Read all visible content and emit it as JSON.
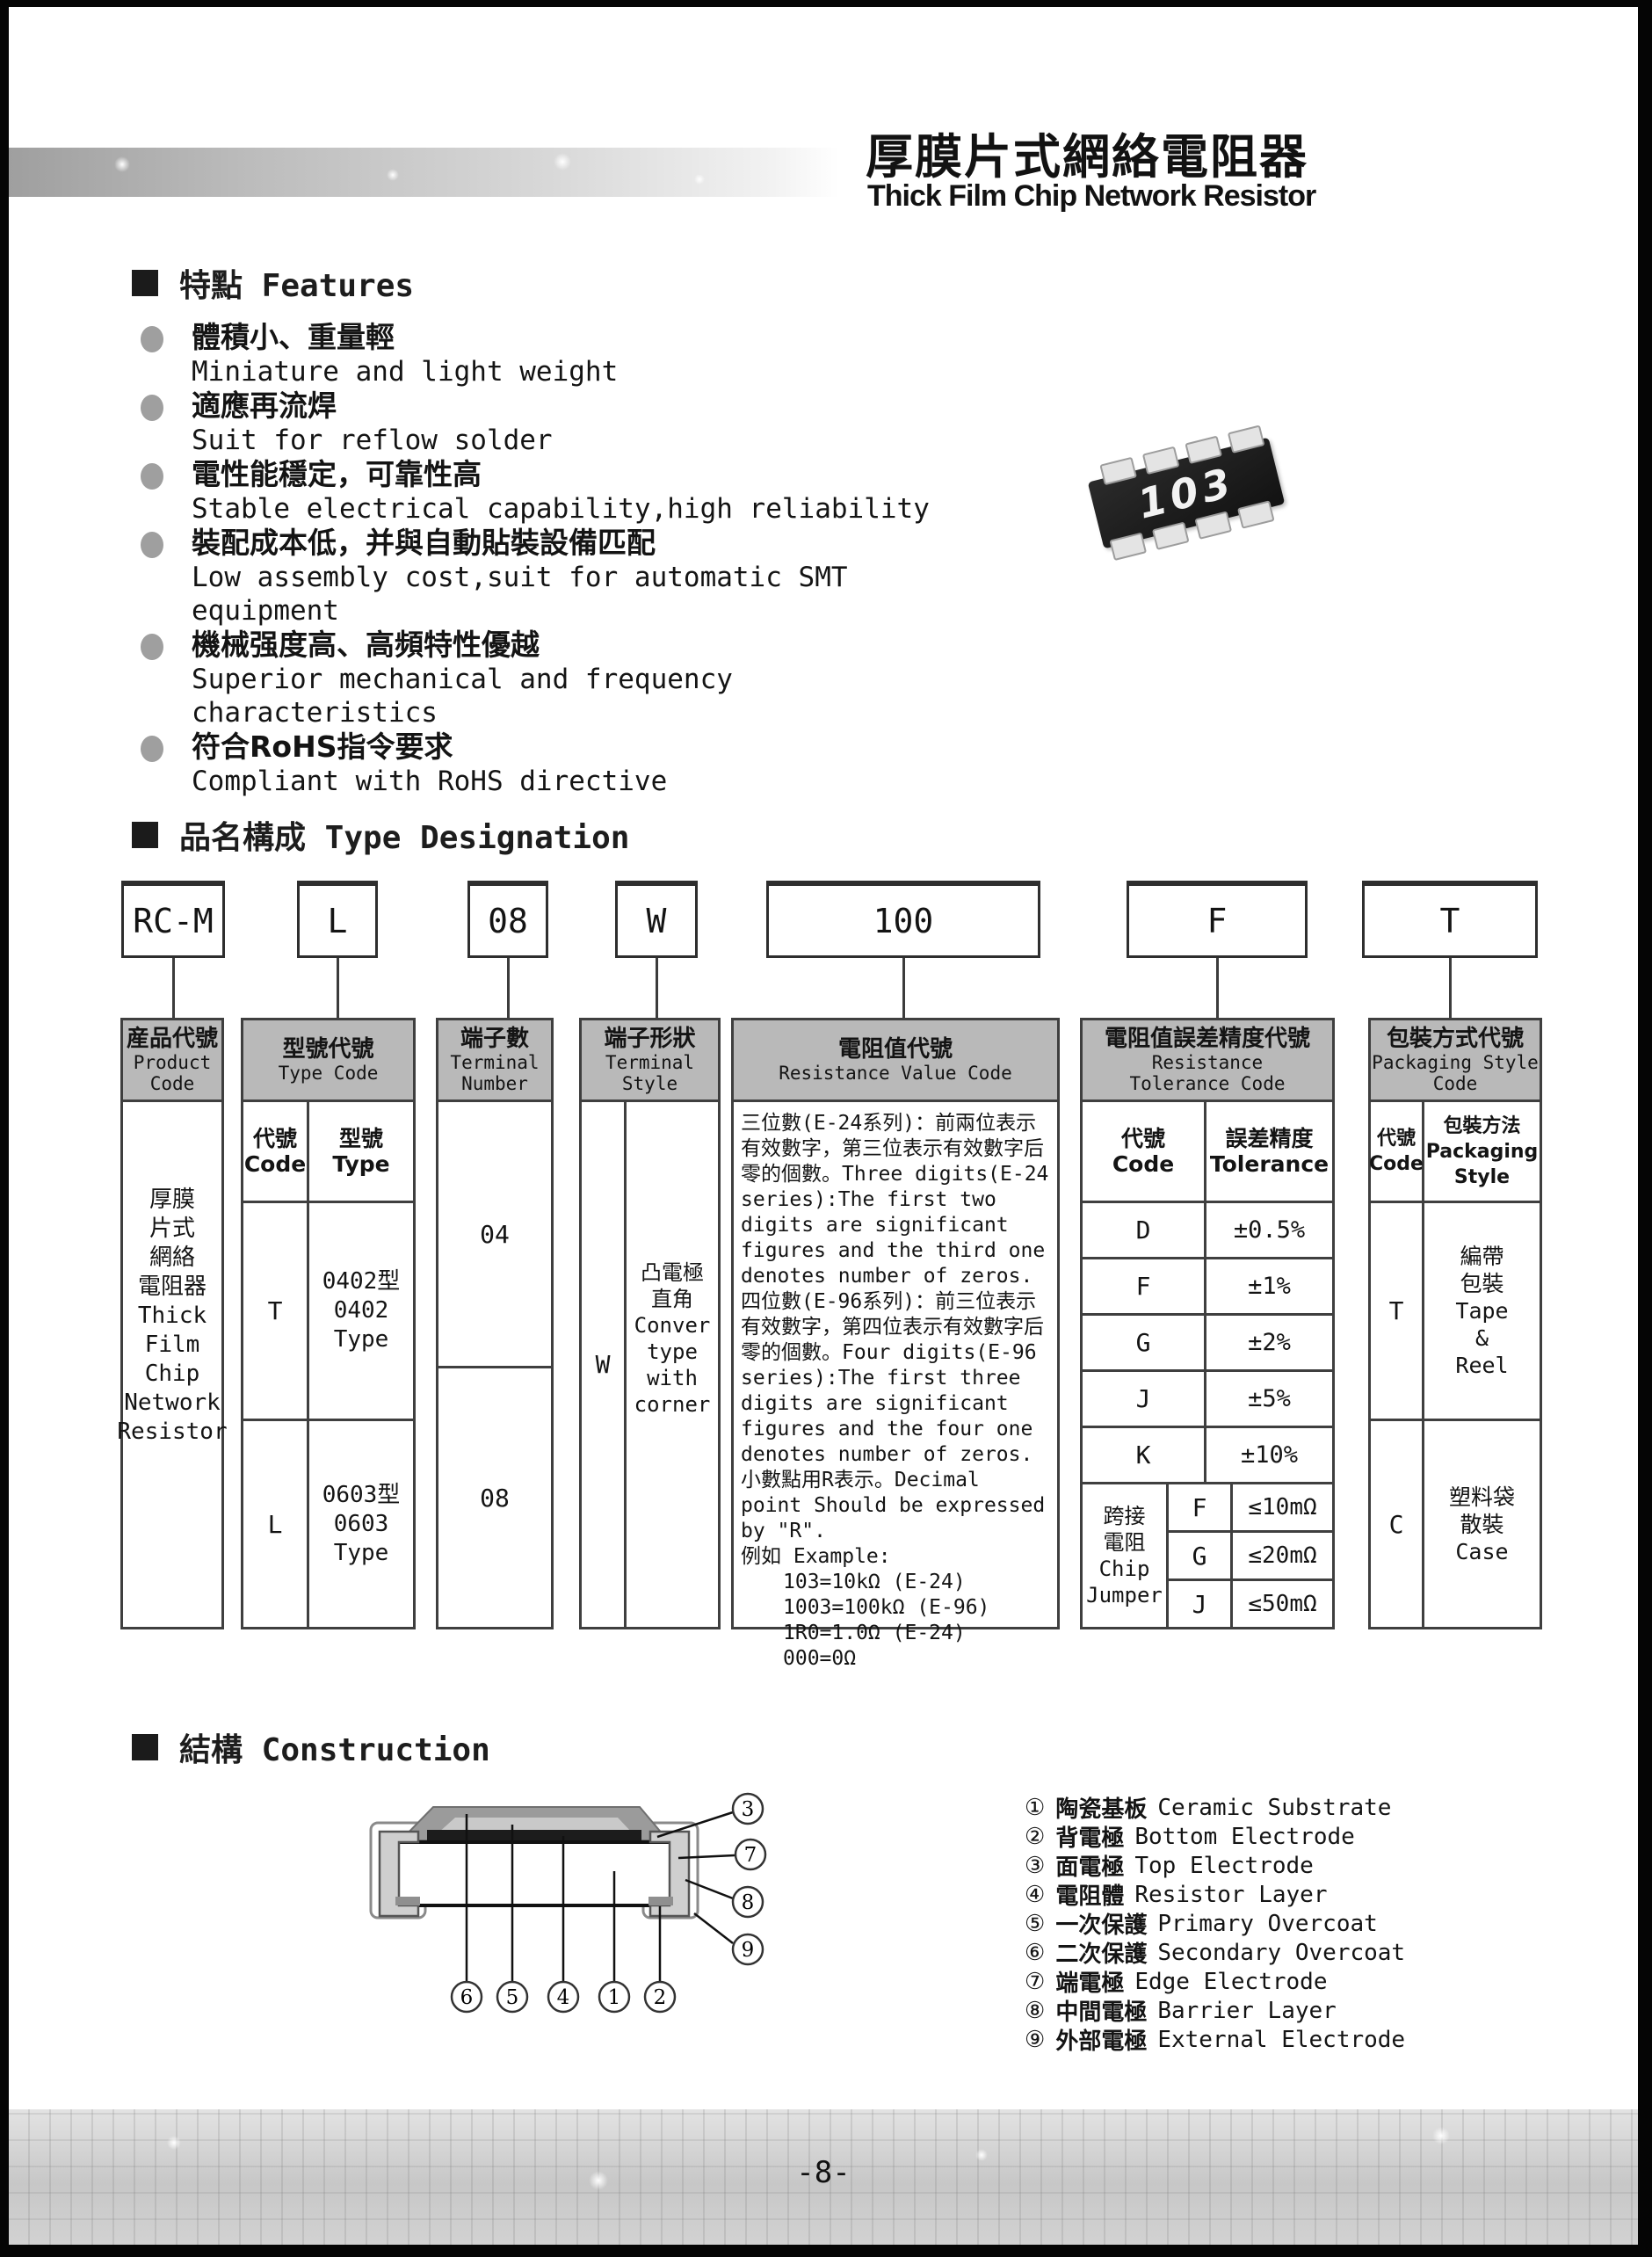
{
  "page": {
    "number": "-8-"
  },
  "header": {
    "title_cn": "厚膜片式網絡電阻器",
    "title_en": "Thick Film Chip Network Resistor"
  },
  "features": {
    "heading": "特點 Features",
    "chip_marking": "103",
    "items": [
      {
        "cn": "體積小、重量輕",
        "en": "Miniature and light weight"
      },
      {
        "cn": "適應再流焊",
        "en": "Suit for reflow solder"
      },
      {
        "cn": "電性能穩定，可靠性高",
        "en": "Stable electrical capability,high reliability"
      },
      {
        "cn": "裝配成本低，并與自動貼裝設備匹配",
        "en": "Low assembly cost,suit for automatic SMT equipment"
      },
      {
        "cn": "機械强度高、高頻特性優越",
        "en": "Superior mechanical and frequency characteristics"
      },
      {
        "cn": "符合RoHS指令要求",
        "en": "Compliant with RoHS directive"
      }
    ]
  },
  "type_designation": {
    "heading": "品名構成  Type Designation",
    "codes": {
      "product": "RC-M",
      "type": "L",
      "terminal_number": "08",
      "terminal_style": "W",
      "resistance_value": "100",
      "tolerance": "F",
      "packaging": "T"
    },
    "product_col": {
      "header_cn": "産品代號",
      "header_en": "Product\nCode",
      "body": "厚膜\n片式\n網絡\n電阻器\nThick\nFilm\nChip\nNetwork\nResistor"
    },
    "type_col": {
      "header_cn": "型號代號",
      "header_en": "Type Code",
      "sub_code": "代號\nCode",
      "sub_type": "型號\nType",
      "rows": [
        {
          "code": "T",
          "type": "0402型\n0402 Type"
        },
        {
          "code": "L",
          "type": "0603型\n0603 Type"
        }
      ]
    },
    "terminal_number_col": {
      "header_cn": "端子數",
      "header_en": "Terminal\nNumber",
      "rows": [
        "04",
        "08"
      ]
    },
    "terminal_style_col": {
      "header_cn": "端子形狀",
      "header_en": "Terminal\nStyle",
      "code": "W",
      "desc": "凸電極\n直角\nConver\ntype\nwith\ncorner"
    },
    "resistance_col": {
      "header_cn": "電阻值代號",
      "header_en": "Resistance Value Code",
      "p1": "三位數(E-24系列)：前兩位表示有效數字，第三位表示有效數字后零的個數。Three digits(E-24 series):The first two digits are significant figures and the third one denotes number of zeros.",
      "p2": "四位數(E-96系列)：前三位表示有效數字，第四位表示有效數字后零的個數。Four digits(E-96 series):The first three digits are significant figures and the four one denotes number of zeros.",
      "p3": "小數點用R表示。Decimal point Should be expressed by \"R\".",
      "p4": "例如 Example:",
      "examples": "103=10kΩ (E-24)\n1003=100kΩ (E-96)\n1R0=1.0Ω  (E-24)\n000=0Ω"
    },
    "tolerance_col": {
      "header_cn": "電阻值誤差精度代號",
      "header_en": "Resistance\nTolerance Code",
      "sub_code": "代號\nCode",
      "sub_tol": "誤差精度\nTolerance",
      "rows": [
        {
          "code": "D",
          "tol": "±0.5%"
        },
        {
          "code": "F",
          "tol": "±1%"
        },
        {
          "code": "G",
          "tol": "±2%"
        },
        {
          "code": "J",
          "tol": "±5%"
        },
        {
          "code": "K",
          "tol": "±10%"
        }
      ],
      "jumper": {
        "label": "跨接\n電阻\nChip\nJumper",
        "rows": [
          {
            "code": "F",
            "tol": "≤10mΩ"
          },
          {
            "code": "G",
            "tol": "≤20mΩ"
          },
          {
            "code": "J",
            "tol": "≤50mΩ"
          }
        ]
      }
    },
    "packaging_col": {
      "header_cn": "包裝方式代號",
      "header_en": "Packaging Style\nCode",
      "sub_code": "代號\nCode",
      "sub_style": "包裝方法\nPackaging\nStyle",
      "rows": [
        {
          "code": "T",
          "style": "編帶\n包裝\nTape\n&\nReel"
        },
        {
          "code": "C",
          "style": "塑料袋\n散裝\nCase"
        }
      ]
    }
  },
  "construction": {
    "heading": "結構 Construction",
    "callouts": {
      "c1": "1",
      "c2": "2",
      "c3": "3",
      "c4": "4",
      "c5": "5",
      "c6": "6",
      "c7": "7",
      "c8": "8",
      "c9": "9"
    },
    "legend": [
      {
        "num": "①",
        "cn": "陶瓷基板",
        "en": "Ceramic Substrate"
      },
      {
        "num": "②",
        "cn": "背電極",
        "en": "Bottom Electrode"
      },
      {
        "num": "③",
        "cn": "面電極",
        "en": "Top Electrode"
      },
      {
        "num": "④",
        "cn": "電阻體",
        "en": "Resistor Layer"
      },
      {
        "num": "⑤",
        "cn": "一次保護",
        "en": "Primary Overcoat"
      },
      {
        "num": "⑥",
        "cn": "二次保護",
        "en": "Secondary Overcoat"
      },
      {
        "num": "⑦",
        "cn": "端電極",
        "en": "Edge Electrode"
      },
      {
        "num": "⑧",
        "cn": "中間電極",
        "en": "Barrier Layer"
      },
      {
        "num": "⑨",
        "cn": "外部電極",
        "en": "External Electrode"
      }
    ]
  },
  "colors": {
    "table_header_bg": "#b9b9b9",
    "border_dark": "#3f3f3f",
    "bullet_gray": "#9f9f9f"
  }
}
